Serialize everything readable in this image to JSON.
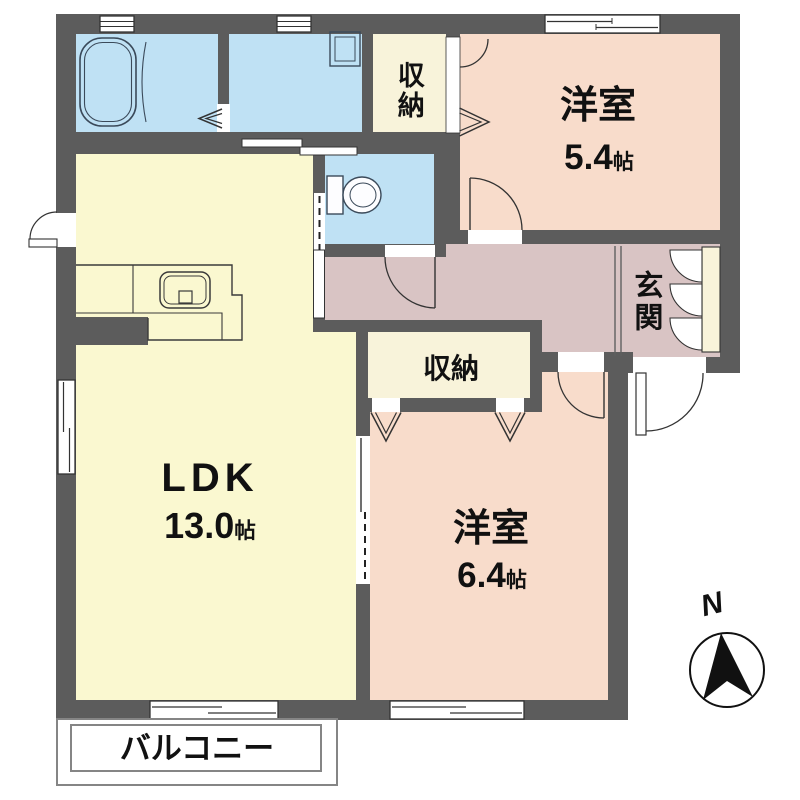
{
  "plan": {
    "rooms": {
      "ldk": {
        "name": "LDK",
        "size": "13.0",
        "unit": "帖"
      },
      "bedroom_small": {
        "name": "洋室",
        "size": "5.4",
        "unit": "帖"
      },
      "bedroom_large": {
        "name": "洋室",
        "size": "6.4",
        "unit": "帖"
      },
      "closet_top": {
        "name": "収納"
      },
      "closet_middle": {
        "name": "収納"
      },
      "entrance": {
        "name": "玄関"
      },
      "balcony": {
        "name": "バルコニー"
      }
    },
    "compass": {
      "north_label": "N"
    },
    "fixtures": [
      "bathtub",
      "washing-machine-pan",
      "toilet",
      "kitchen-counter-sink",
      "shoe-cabinet",
      "north-arrow"
    ],
    "colors": {
      "wall": "#5c5c5c",
      "wet_area": "#bfe1f4",
      "ldk": "#faf8d0",
      "bedroom": "#f8dccb",
      "hallway": "#d9c4c4",
      "closet": "#f8f3da",
      "outline": "#333333"
    }
  }
}
